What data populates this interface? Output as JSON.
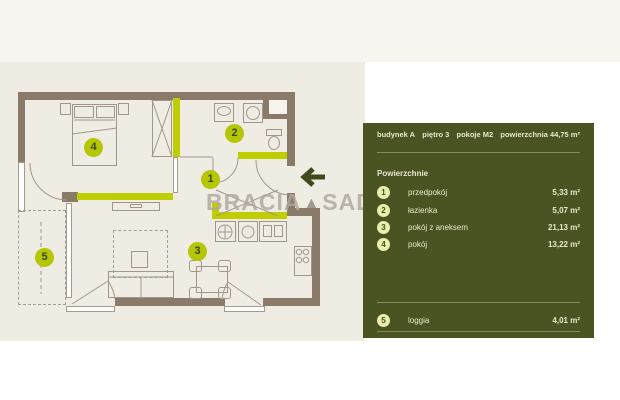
{
  "watermark": {
    "left": "BRACIA",
    "logo": "▲",
    "right": "SADURSCY"
  },
  "panel": {
    "header": [
      "budynek A",
      "piętro 3",
      "pokoje M2",
      "powierzchnia 44,75 m²"
    ],
    "section_title": "Powierzchnie",
    "rooms": [
      {
        "num": "1",
        "label": "przedpokój",
        "area": "5,33 m²"
      },
      {
        "num": "2",
        "label": "łazienka",
        "area": "5,07 m²"
      },
      {
        "num": "3",
        "label": "pokój z aneksem",
        "area": "21,13 m²"
      },
      {
        "num": "4",
        "label": "pokój",
        "area": "13,22 m²"
      },
      {
        "num": "5",
        "label": "loggia",
        "area": "4,01 m²"
      }
    ]
  },
  "floorplan": {
    "markers": [
      "1",
      "2",
      "3",
      "4",
      "5"
    ]
  },
  "icons": {
    "back_arrow": "left-arrow"
  },
  "colors": {
    "accent_lime": "#BFCE00",
    "panel_olive": "#4A5422",
    "wall_brown": "#8A7A69",
    "marker_lime": "#B5C604",
    "plan_background": "#EFECE4"
  }
}
